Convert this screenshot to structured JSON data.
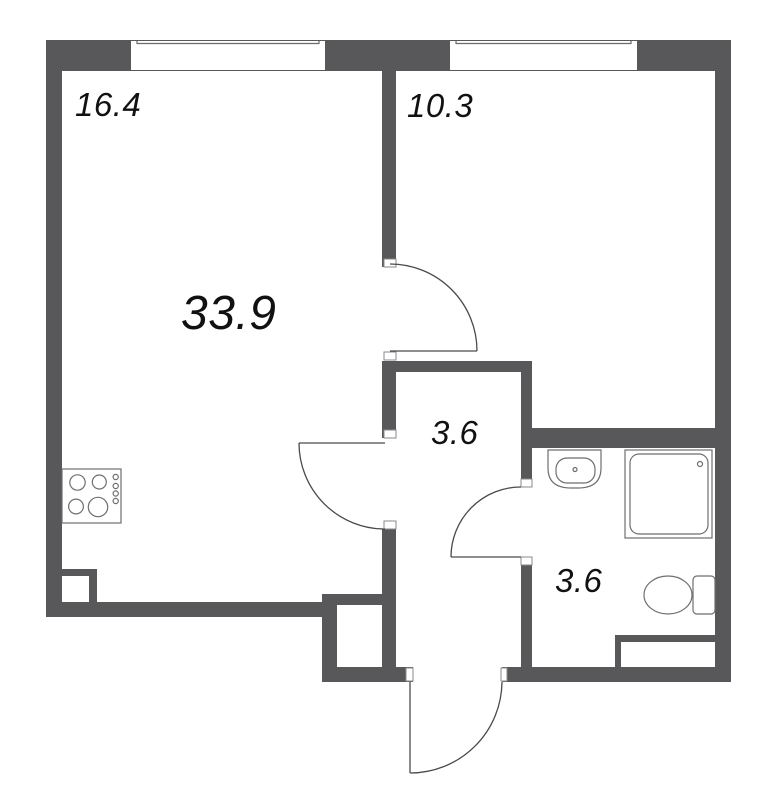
{
  "floor_plan": {
    "room_labels": {
      "top_left_room": "16.4",
      "main_area": "33.9",
      "top_right_room": "10.3",
      "hallway": "3.6",
      "bathroom": "3.6"
    },
    "fixture_icons": {
      "cooktop": "cooktop-icon-4-burners-with-knobs",
      "sink": "washbasin-icon",
      "shower": "shower-tray-icon",
      "toilet": "toilet-icon"
    },
    "window_icons": {
      "top_left": "window-icon",
      "top_right": "window-icon"
    },
    "door_icons": {
      "room_door": "door-swing-arc-icon",
      "living_hallway_door": "door-swing-arc-icon",
      "bathroom_door": "door-swing-arc-icon",
      "entrance_door": "door-swing-arc-icon"
    },
    "colors": {
      "wall": "#58585a",
      "door_line": "#4a4a4a",
      "fixture_line": "#6e6e6e",
      "window_line": "#6a6a6a",
      "cap_line": "#8a8a8a",
      "text": "#111111",
      "background": "#ffffff"
    }
  }
}
